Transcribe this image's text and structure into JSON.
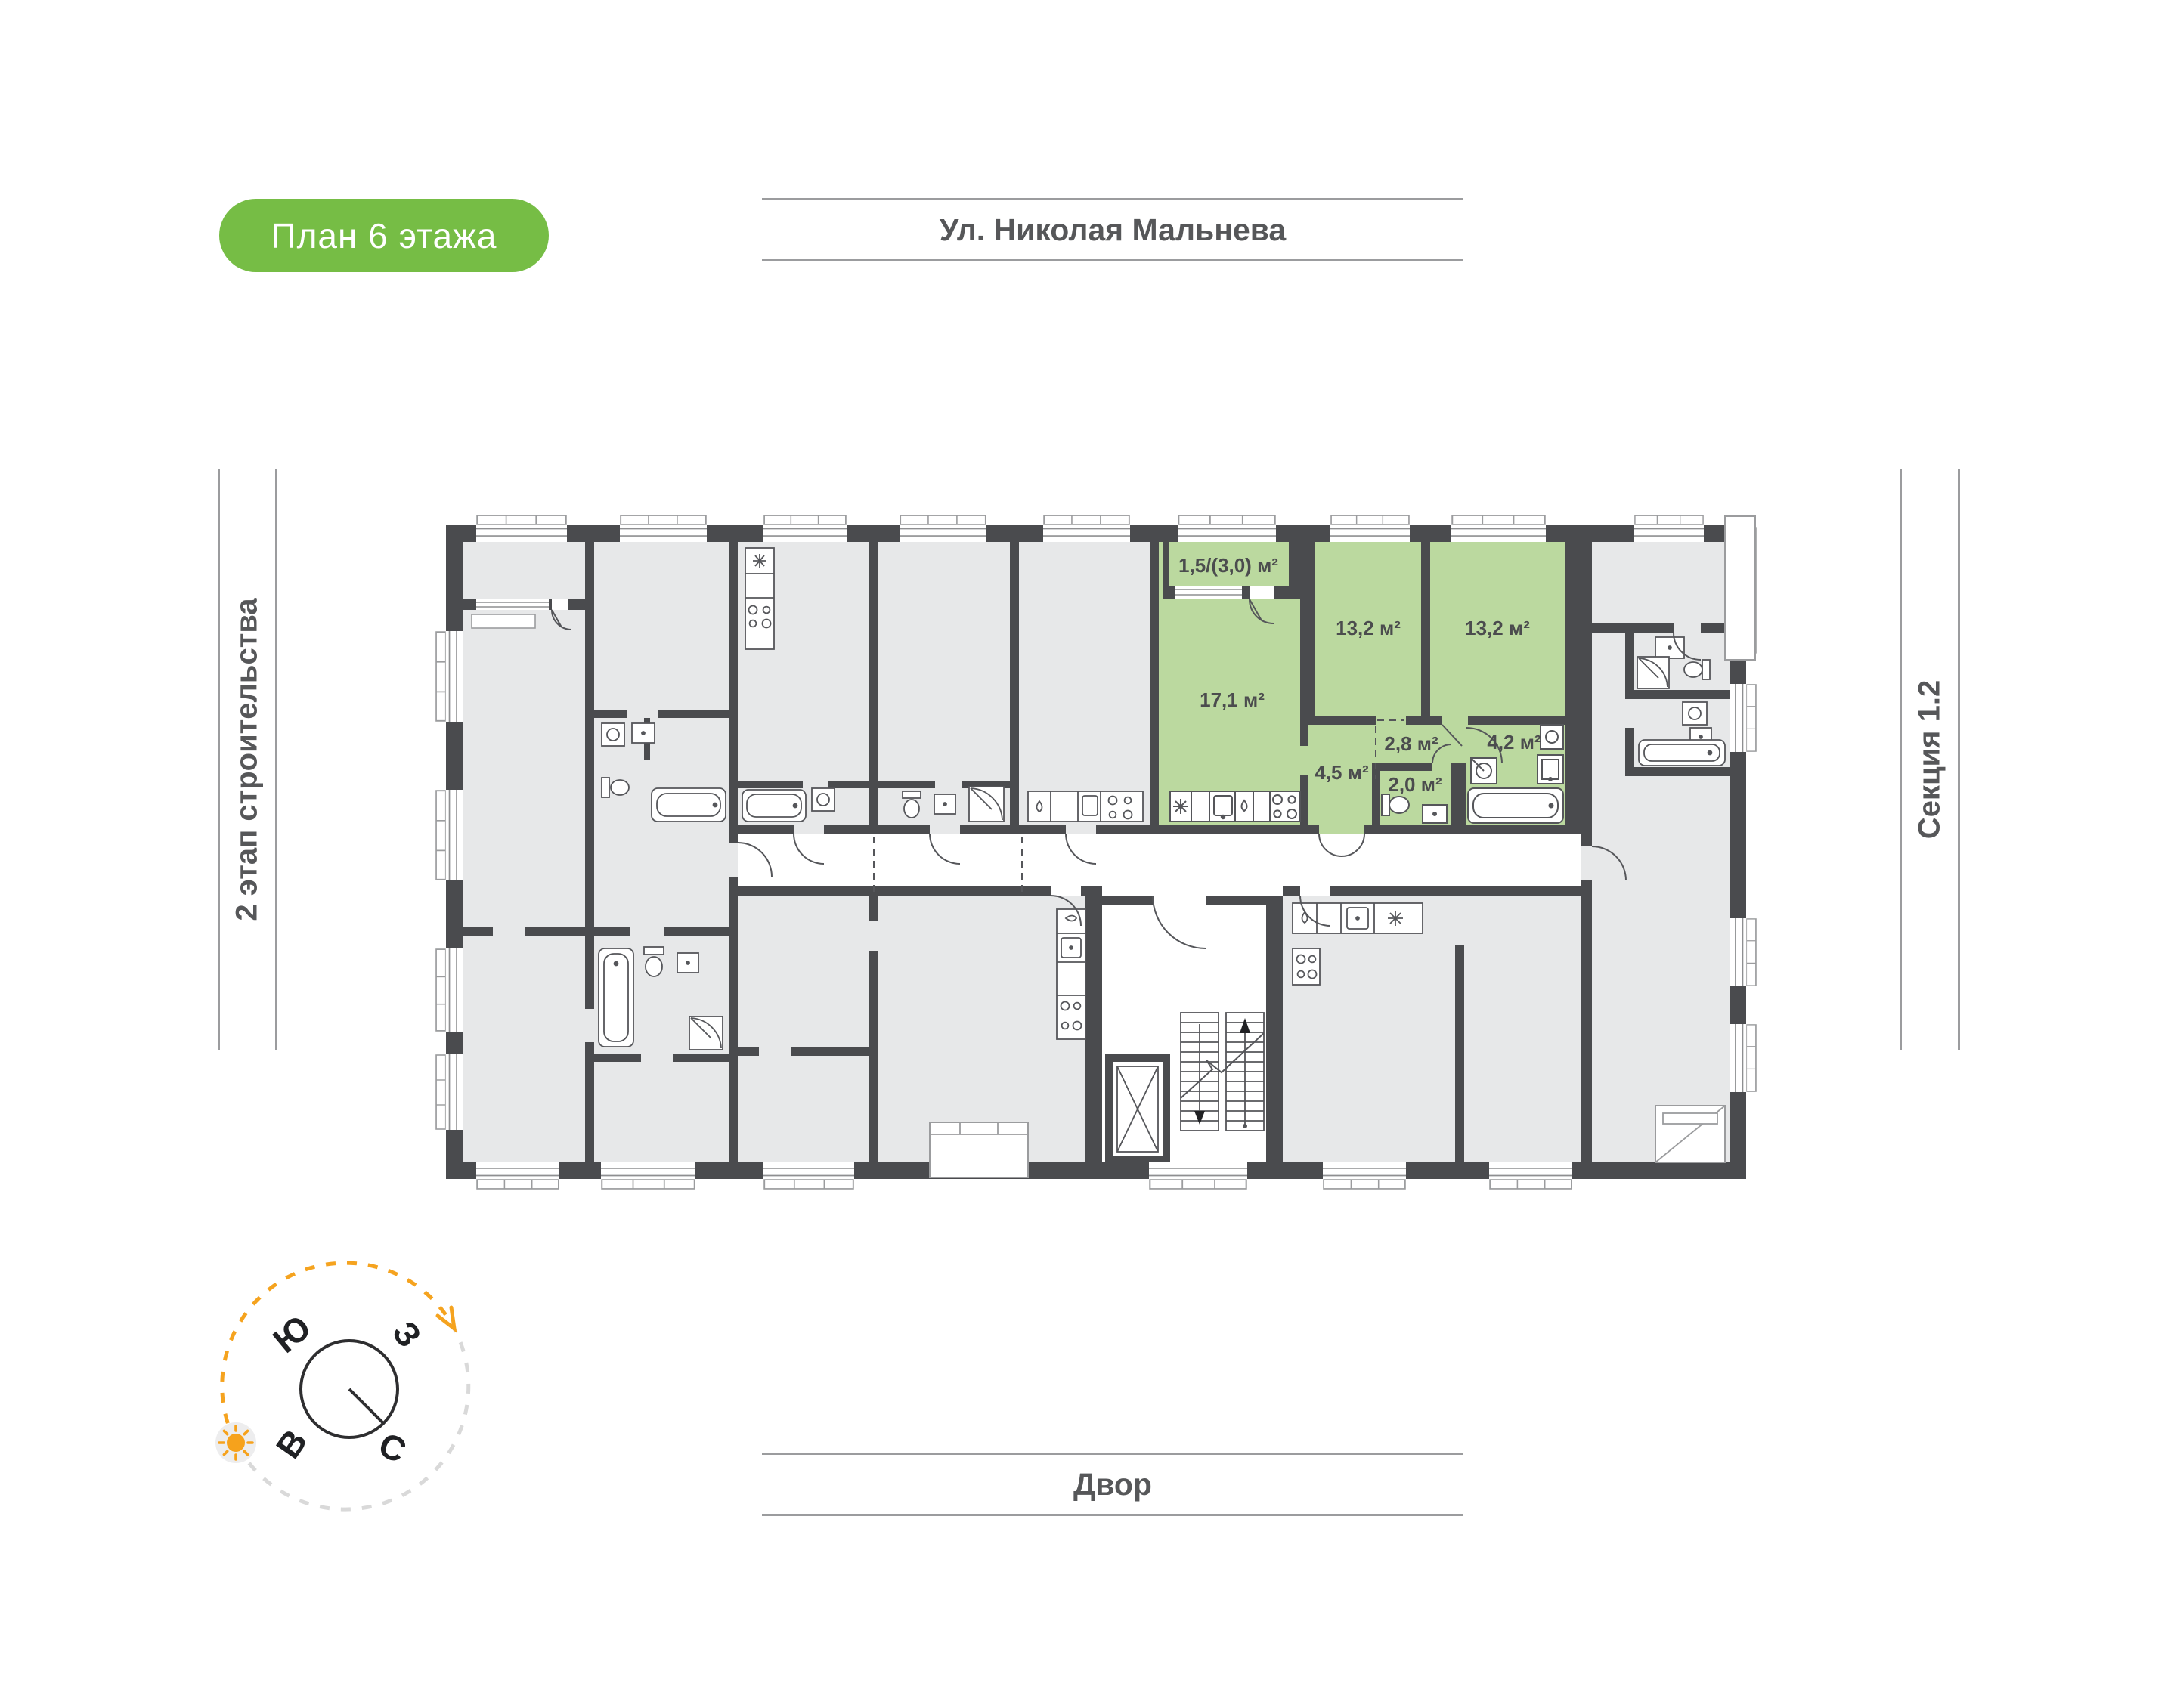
{
  "badge": {
    "label": "План 6 этажа"
  },
  "labels": {
    "street": "Ул. Николая Мальнева",
    "construction_stage": "2 этап строительства",
    "section": "Секция 1.2",
    "courtyard": "Двор"
  },
  "compass": {
    "south": "Ю",
    "west": "З",
    "east": "В",
    "north": "С"
  },
  "plan": {
    "highlighted_apartment": {
      "rooms": [
        {
          "name": "balcony",
          "area": "1,5/(3,0) м²"
        },
        {
          "name": "living-kitchen",
          "area": "17,1 м²"
        },
        {
          "name": "bedroom-1",
          "area": "13,2 м²"
        },
        {
          "name": "bedroom-2",
          "area": "13,2 м²"
        },
        {
          "name": "hallway",
          "area": "4,5 м²"
        },
        {
          "name": "hall",
          "area": "2,8 м²"
        },
        {
          "name": "wc",
          "area": "2,0 м²"
        },
        {
          "name": "bathroom",
          "area": "4,2 м²"
        }
      ]
    }
  },
  "colors": {
    "badge_green": "#76bd45",
    "apartment_green": "#bbd99f",
    "wall_dark": "#4a4b4e",
    "room_gray": "#e7e8e9",
    "line_gray": "#9b9c9e",
    "accent_orange": "#f5a31f",
    "plan_text": "#4b4c4e",
    "label_text": "#565759"
  }
}
